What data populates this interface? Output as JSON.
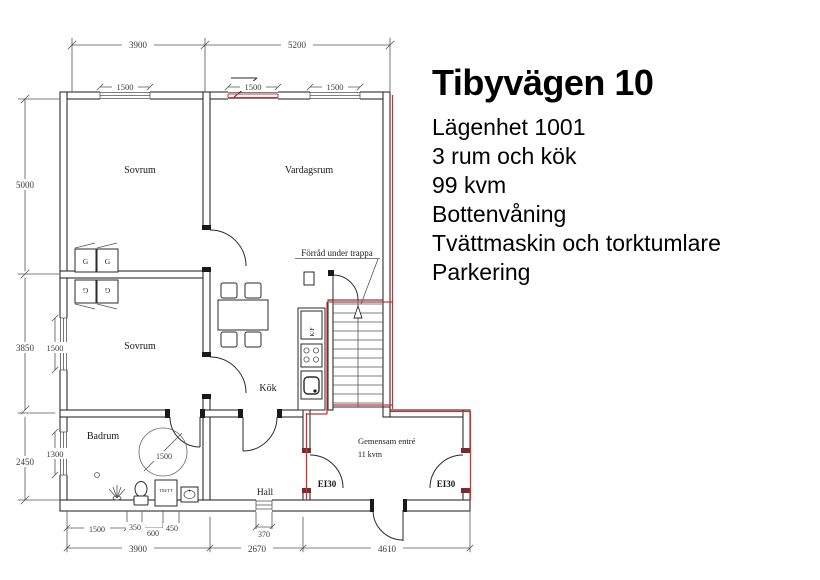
{
  "colors": {
    "highlight_red": "#cc3333",
    "wall_line": "#1a1a1a",
    "dim_line": "#555555"
  },
  "info_panel": {
    "title": "Tibyvägen 10",
    "lines": [
      "Lägenhet 1001",
      "3 rum och kök",
      "99 kvm",
      "Bottenvåning",
      "Tvättmaskin och torktumlare",
      "Parkering"
    ]
  },
  "plan": {
    "rooms": {
      "bedroom1": "Sovrum",
      "living_room": "Vardagsrum",
      "bedroom2": "Sovrum",
      "kitchen": "Kök",
      "bathroom": "Badrum",
      "hall": "Hall",
      "shared_entry_line1": "Gemensam entré",
      "shared_entry_line2": "11 kvm",
      "storage_note": "Förråd under trappa"
    },
    "fire_doors": {
      "left": "EI30",
      "right": "EI30"
    },
    "fixtures": {
      "wardrobe": "G",
      "fridge_freezer": "K/F",
      "washer_dryer": "TM/TT",
      "turning_circle": "1500"
    },
    "dimensions": {
      "top_left": "3900",
      "top_right": "5200",
      "window_top1": "1500",
      "window_top2": "1500",
      "window_top3": "1500",
      "left_upper": "5000",
      "left_middle": "3850",
      "left_lower": "2450",
      "window_left1": "1500",
      "window_left2": "1300",
      "bath_clear": "1500",
      "bath_wc": "350",
      "bath_tm": "600",
      "bath_sink": "450",
      "hall_window": "370",
      "bottom_left": "3900",
      "bottom_middle": "2670",
      "bottom_right": "4610"
    }
  }
}
